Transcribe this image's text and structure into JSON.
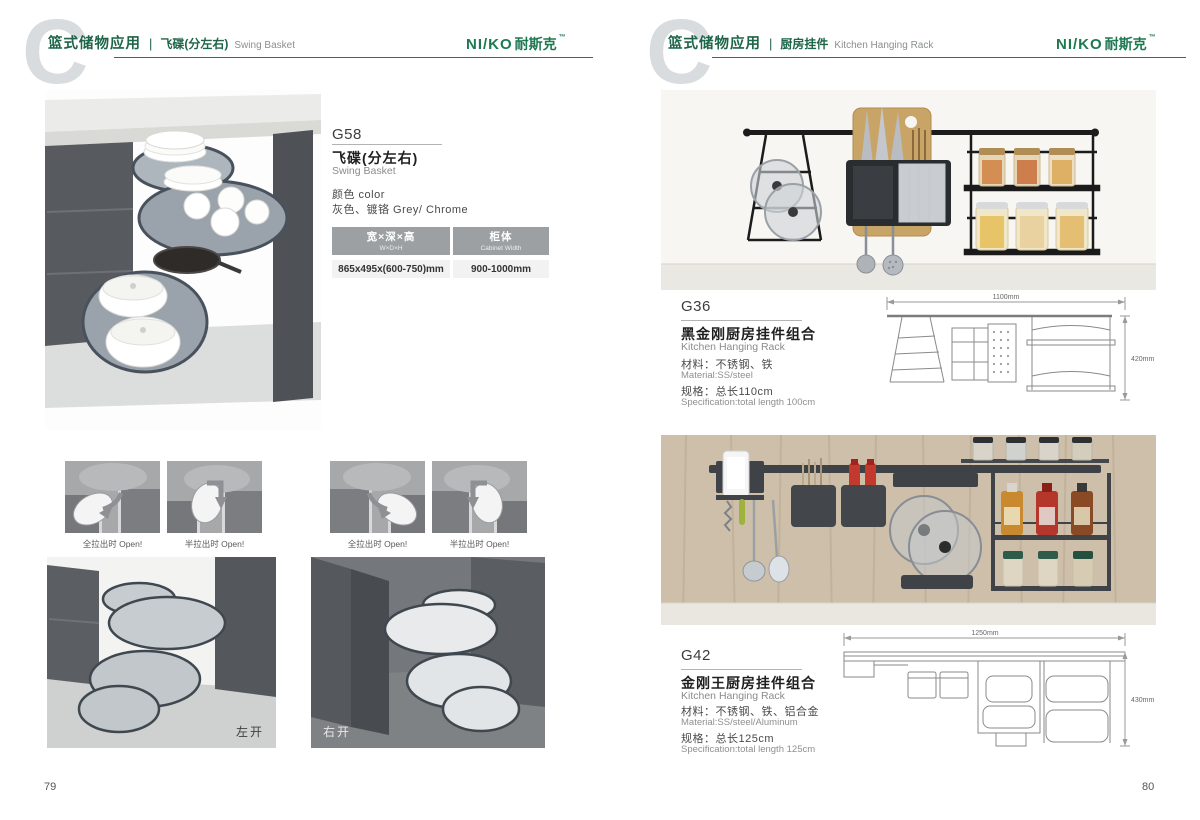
{
  "colors": {
    "brand_green": "#1d7a50",
    "header_green": "#1e6549",
    "rail_black": "#1c1c1c"
  },
  "logo": {
    "latin": "NI/KO",
    "cjk": "耐斯克",
    "mark": "™"
  },
  "page_left": {
    "page_number": "79",
    "header": {
      "category": "篮式储物应用",
      "subtitle_cn": "飞碟(分左右)",
      "subtitle_en": "Swing Basket"
    },
    "product": {
      "code": "G58",
      "name_cn": "飞碟(分左右)",
      "name_en": "Swing Basket",
      "color_label": "颜色 color",
      "color_value": "灰色、镀铬 Grey/ Chrome",
      "table": {
        "col1": {
          "header_cn": "宽×深×高",
          "header_en": "W×D×H",
          "value": "865x495x(600-750)mm"
        },
        "col2": {
          "header_cn": "柜体",
          "header_en": "Cabinet Width",
          "value": "900-1000mm"
        }
      }
    },
    "captions": {
      "full": "全拉出时 Open!",
      "half": "半拉出时 Open!"
    },
    "photo_labels": {
      "left": "左开",
      "right": "右开"
    }
  },
  "page_right": {
    "page_number": "80",
    "header": {
      "category": "篮式储物应用",
      "subtitle_cn": "厨房挂件",
      "subtitle_en": "Kitchen Hanging Rack"
    },
    "products": [
      {
        "code": "G36",
        "name_cn": "黑金刚厨房挂件组合",
        "name_en": "Kitchen Hanging Rack",
        "material_cn": "材料：不锈钢、铁",
        "material_en": "Material:SS/steel",
        "spec_cn": "规格：总长110cm",
        "spec_en": "Specification:total length 100cm",
        "dim_width": "1100mm",
        "dim_height": "420mm"
      },
      {
        "code": "G42",
        "name_cn": "金刚王厨房挂件组合",
        "name_en": "Kitchen Hanging Rack",
        "material_cn": "材料：不锈钢、铁、铝合金",
        "material_en": "Material:SS/steel/Aluminum",
        "spec_cn": "规格：总长125cm",
        "spec_en": "Specification:total length 125cm",
        "dim_width": "1250mm",
        "dim_height": "430mm"
      }
    ]
  }
}
